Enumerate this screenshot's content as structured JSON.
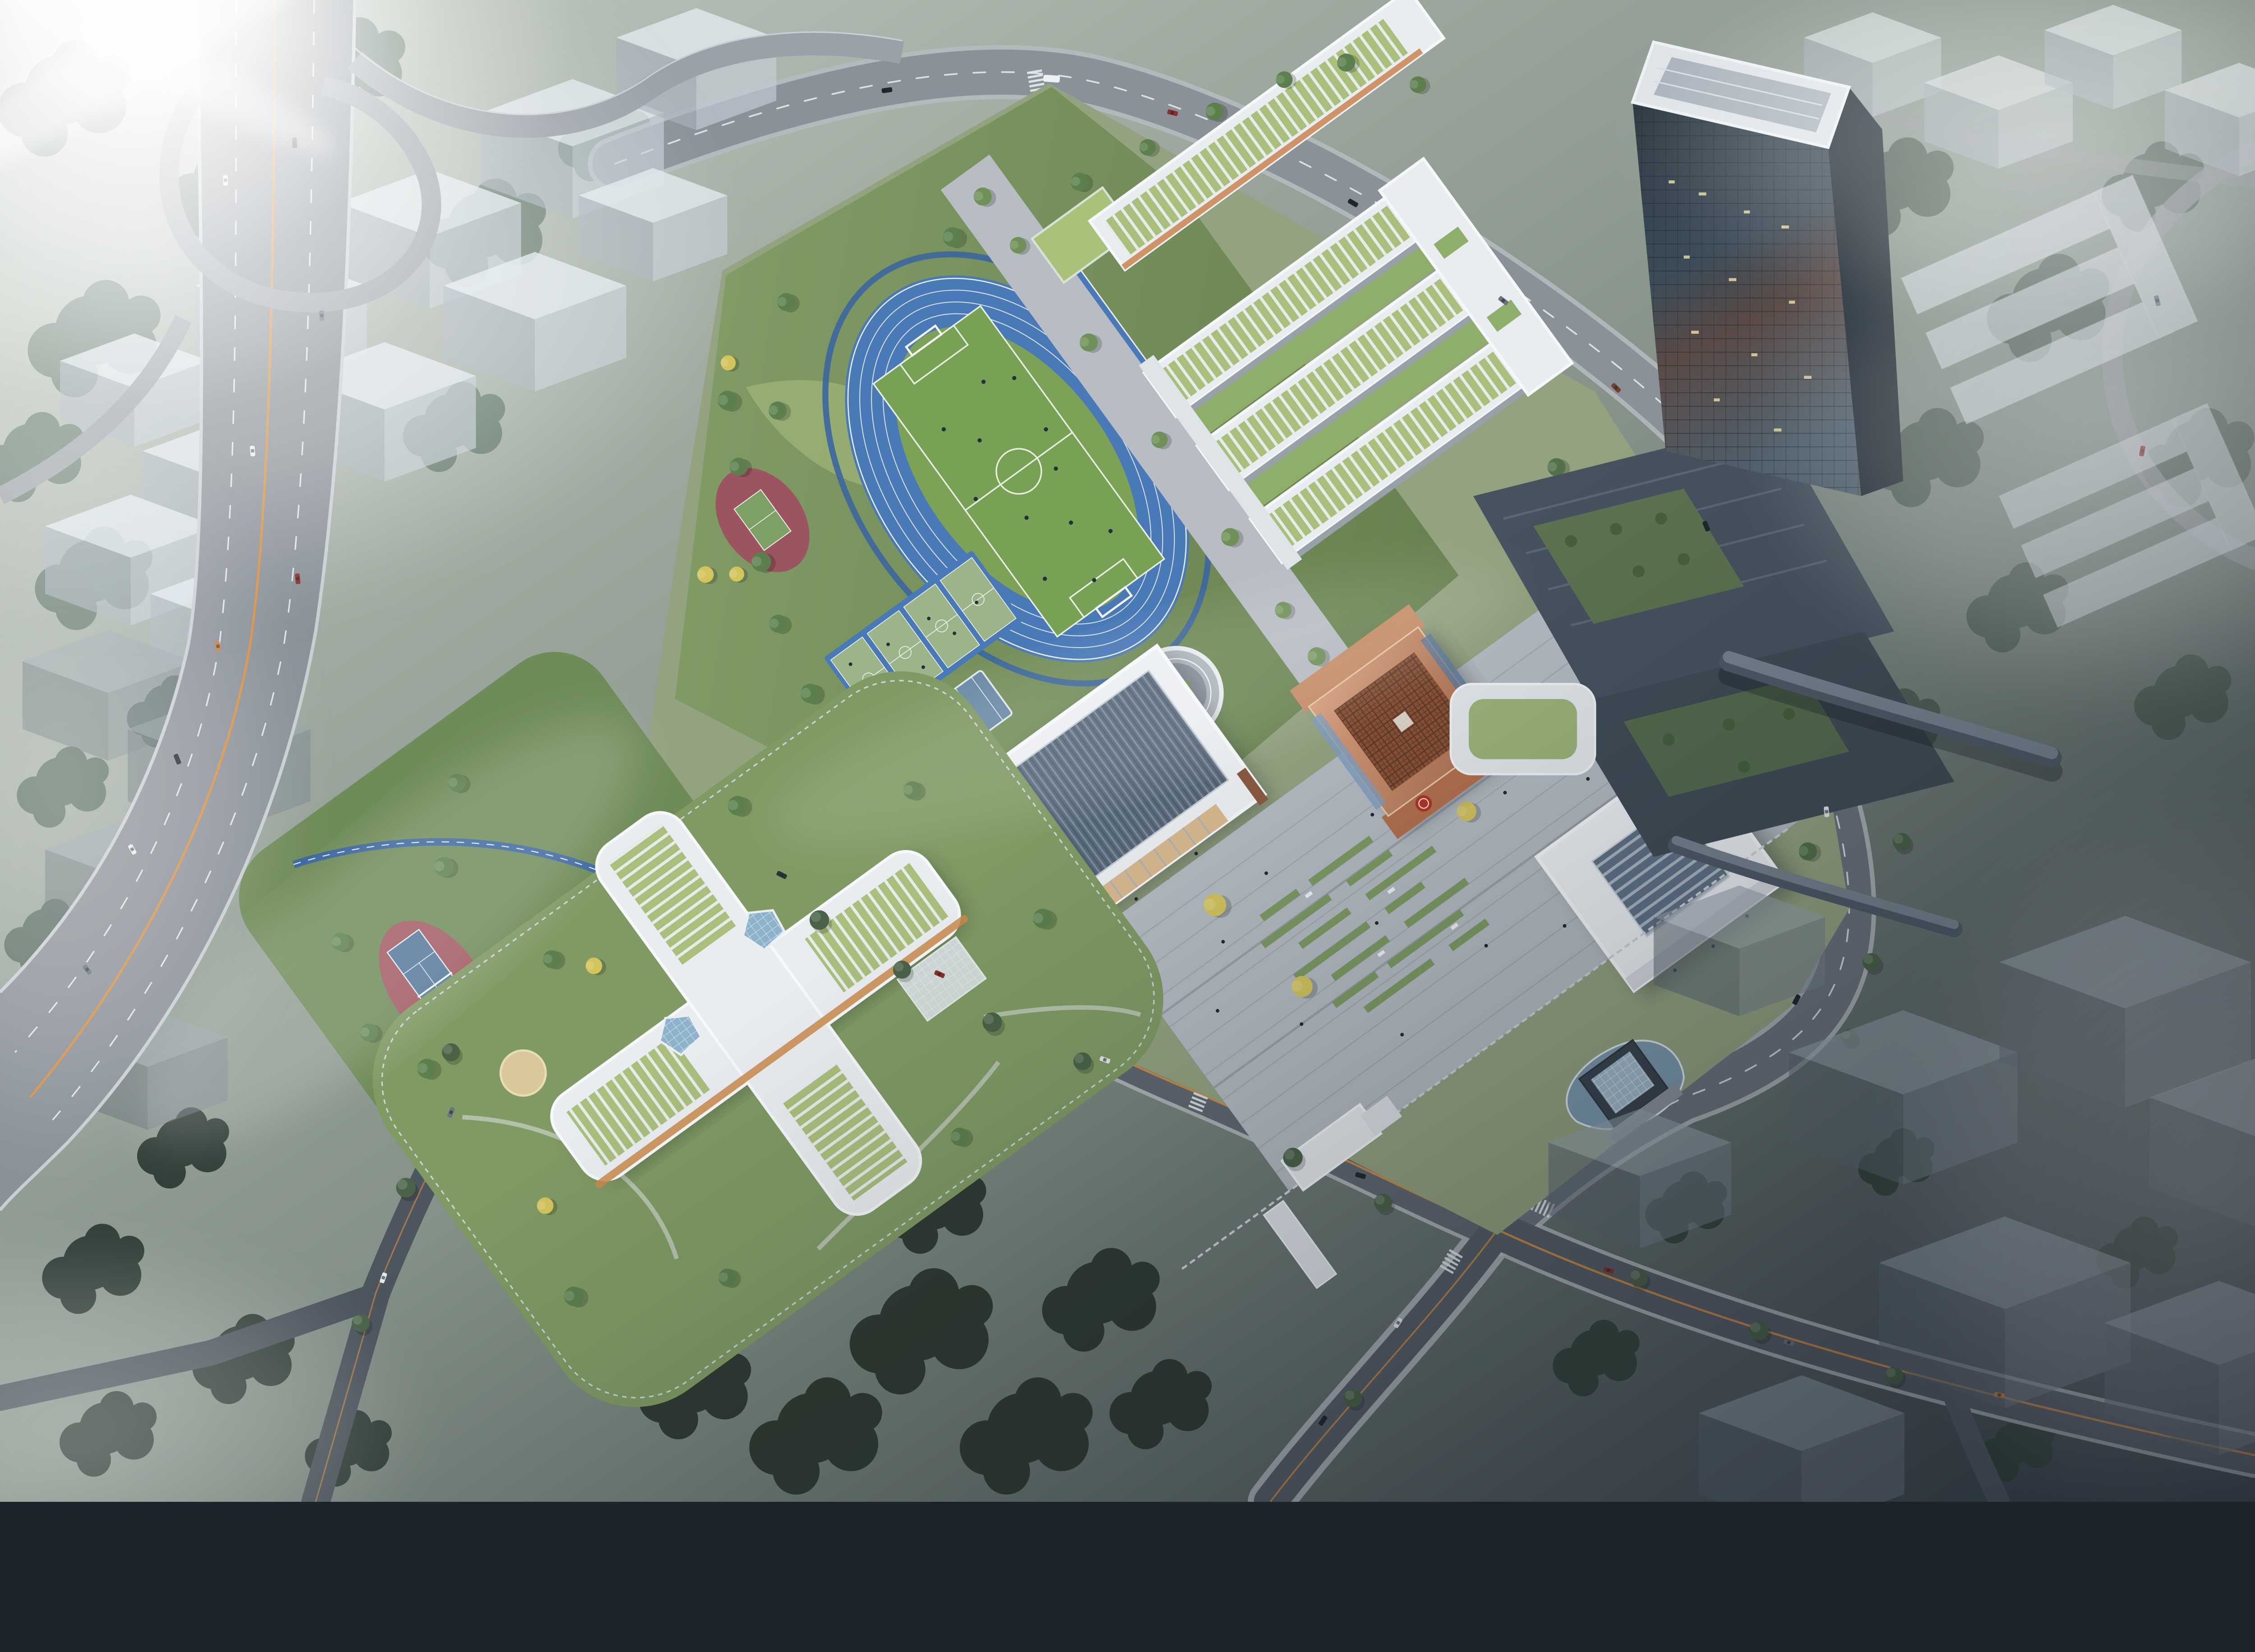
{
  "meta": {
    "description": "Bird's-eye architectural rendering at dusk of a new school campus: blue running track with soccer field, basketball and tennis courts, white classroom courtyard buildings with green louvered roofs, a copper lattice hall with red seal emblem, a ridged-roof auditorium, a gymnasium, a four-wing building with skylights, a dark glass office tower with terraced podium and sky bridges, an elevated highway interchange with traffic, surrounding translucent massing blocks, dense forest and drifting fog with a bright sun flare in the upper left."
  },
  "palette": {
    "fog_white": "#ffffff",
    "ground_top": "#c6cec5",
    "ground_mid": "#8a978b",
    "ground_dark": "#39434c",
    "highway_asphalt": "#8a9198",
    "road_asphalt": "#757d85",
    "road_dark": "#555e67",
    "lane_white": "#e9edf0",
    "median_orange": "#d8903f",
    "curb_light": "#b6bbc0",
    "track_blue": "#4a79b8",
    "infield_green": "#7da257",
    "pitch_green": "#79a155",
    "lawn_green": "#7f9a63",
    "west_lawn_green": "#6f8b58",
    "court_frame_blue": "#4a79b8",
    "court_green": "#9cb489",
    "tennis_red": "#a05a62",
    "tennis_blue": "#55799c",
    "practice_red": "#9c5560",
    "cycleway_blue": "#3c66a0",
    "roof_white": "#e9edf0",
    "roof_green": "#a9c178",
    "auditorium_roof": "#5a6b7c",
    "copper": "#c08663",
    "copper_dark": "#8a5136",
    "seal_red": "#b23527",
    "gym_skylight": "#5f7287",
    "plaza_gray": "#b5bbc2",
    "water_blue": "#7b99ad",
    "tower_glass_dark": "#2c3842",
    "tower_glass_light": "#51626f",
    "podium_slate": "#46535f",
    "tree_green": "#5c7f4d",
    "tree_bright": "#6f9158",
    "tree_dark": "#2e3a31",
    "tree_fog": "#6a7f72",
    "ginkgo_yellow": "#d3c45c",
    "massing_top": "#e1e8ee",
    "people_dark": "#1f2a33"
  },
  "scene": {
    "environment": {
      "sun_flare": "upper-left",
      "fog": "drifting over surrounding city blocks",
      "lighting": "overcast dusk, bright in north-west, dark in south-east"
    },
    "campus": {
      "sports": {
        "running_track_lanes": 6,
        "soccer_fields": 1,
        "basketball_courts": 4,
        "badminton_courts": 2,
        "tennis_courts": 1,
        "practice_courts": 1,
        "long_jump_runways": 1
      },
      "buildings": [
        {
          "label": "north classroom wing",
          "roof": "green louvered strips",
          "facade": "white frame with orange window bands"
        },
        {
          "label": "courtyard classroom bars (3)",
          "roof": "green louvered strips",
          "feature": "lawn courtyards and east spine"
        },
        {
          "label": "circular sunken courtyard",
          "feature": "warm lit colonnade ring"
        },
        {
          "label": "auditorium",
          "roof": "dark ridged sawtooth",
          "feature": "lit entrance portal and calligraphy plaque"
        },
        {
          "label": "copper lattice hall",
          "roof": "carved copper lattice",
          "feature": "red circular seal emblem"
        },
        {
          "label": "gymnasium",
          "roof": "white with dark skylight band"
        },
        {
          "label": "four-wing building",
          "roof": "green strips with two faceted skylights",
          "facade": "orange louvers"
        }
      ],
      "landscape": [
        "central plaza with lawn strips and benches",
        "ginkgo trees in planters",
        "pond with fountains and glass pavilion",
        "south entrance gate",
        "blue cycle path",
        "playground",
        "street tree rows"
      ]
    },
    "context": {
      "elevated_highway": true,
      "interchange_ramps": true,
      "glass_tower": {
        "facade": "dark glass with warm lit offices",
        "podium": "terraced slate roofs with gardens"
      },
      "sky_bridges": 2,
      "massing_blocks": "translucent grey volumes in fog",
      "forest": "dense tree canopy"
    },
    "traffic": {
      "cars": true,
      "bus": true,
      "pedestrians": true
    }
  }
}
